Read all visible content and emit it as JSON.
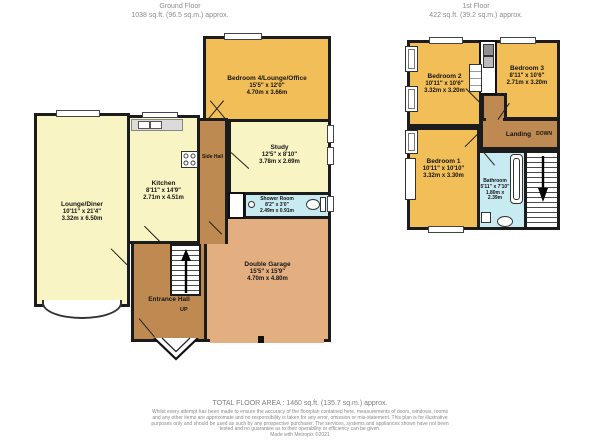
{
  "floors": [
    {
      "name": "Ground Floor",
      "area": "1038 sq.ft. (96.5 sq.m.) approx.",
      "rooms": [
        {
          "name": "Lounge/Diner",
          "dims_ft": "10'11\" x 21'4\"",
          "dims_m": "3.32m x 6.50m"
        },
        {
          "name": "Kitchen",
          "dims_ft": "8'11\" x 14'9\"",
          "dims_m": "2.71m x 4.51m"
        },
        {
          "name": "Side Hall"
        },
        {
          "name": "Bedroom 4/Lounge/Office",
          "dims_ft": "15'5\" x 12'0\"",
          "dims_m": "4.70m x 3.66m"
        },
        {
          "name": "Study",
          "dims_ft": "12'5\" x 8'10\"",
          "dims_m": "3.78m x 2.69m"
        },
        {
          "name": "Shower Room",
          "dims_ft": "8'2\" x 3'0\"",
          "dims_m": "2.49m x 0.91m"
        },
        {
          "name": "Double Garage",
          "dims_ft": "15'5\" x 15'9\"",
          "dims_m": "4.70m x 4.80m"
        },
        {
          "name": "Entrance Hall",
          "direction": "UP"
        }
      ]
    },
    {
      "name": "1st Floor",
      "area": "422 sq.ft. (39.2 sq.m.) approx.",
      "rooms": [
        {
          "name": "Bedroom 2",
          "dims_ft": "10'11\" x 10'6\"",
          "dims_m": "3.32m x 3.20m"
        },
        {
          "name": "Bedroom 3",
          "dims_ft": "8'11\" x 10'6\"",
          "dims_m": "2.71m x 3.20m"
        },
        {
          "name": "Bedroom 1",
          "dims_ft": "10'11\" x 10'10\"",
          "dims_m": "3.32m x 3.30m"
        },
        {
          "name": "Landing",
          "direction": "DOWN"
        },
        {
          "name": "Bathroom",
          "dims_ft": "5'11\" x 7'10\"",
          "dims_m": "1.80m x 2.39m"
        }
      ]
    }
  ],
  "footer": {
    "total": "TOTAL FLOOR AREA : 1460 sq.ft. (135.7 sq.m.) approx.",
    "disclaimer": "Whilst every attempt has been made to ensure the accuracy of the floorplan contained here, measurements of doors, windows, rooms and any other items are approximate and no responsibility is taken for any error, omission or mis-statement. This plan is for illustrative purposes only and should be used as such by any prospective purchaser. The services, systems and appliances shown have not been tested and no guarantee as to their operability or efficiency can be given.",
    "credit": "Made with Metropix ©2021"
  },
  "colors": {
    "room_gold": "#F2BE57",
    "room_cream": "#F8F4C3",
    "room_tan": "#E3AF80",
    "hall_brown": "#BE8A52",
    "wet_blue": "#C8EBF2",
    "wall": "#1C1C1C",
    "text_gray": "#8C8C8C"
  }
}
